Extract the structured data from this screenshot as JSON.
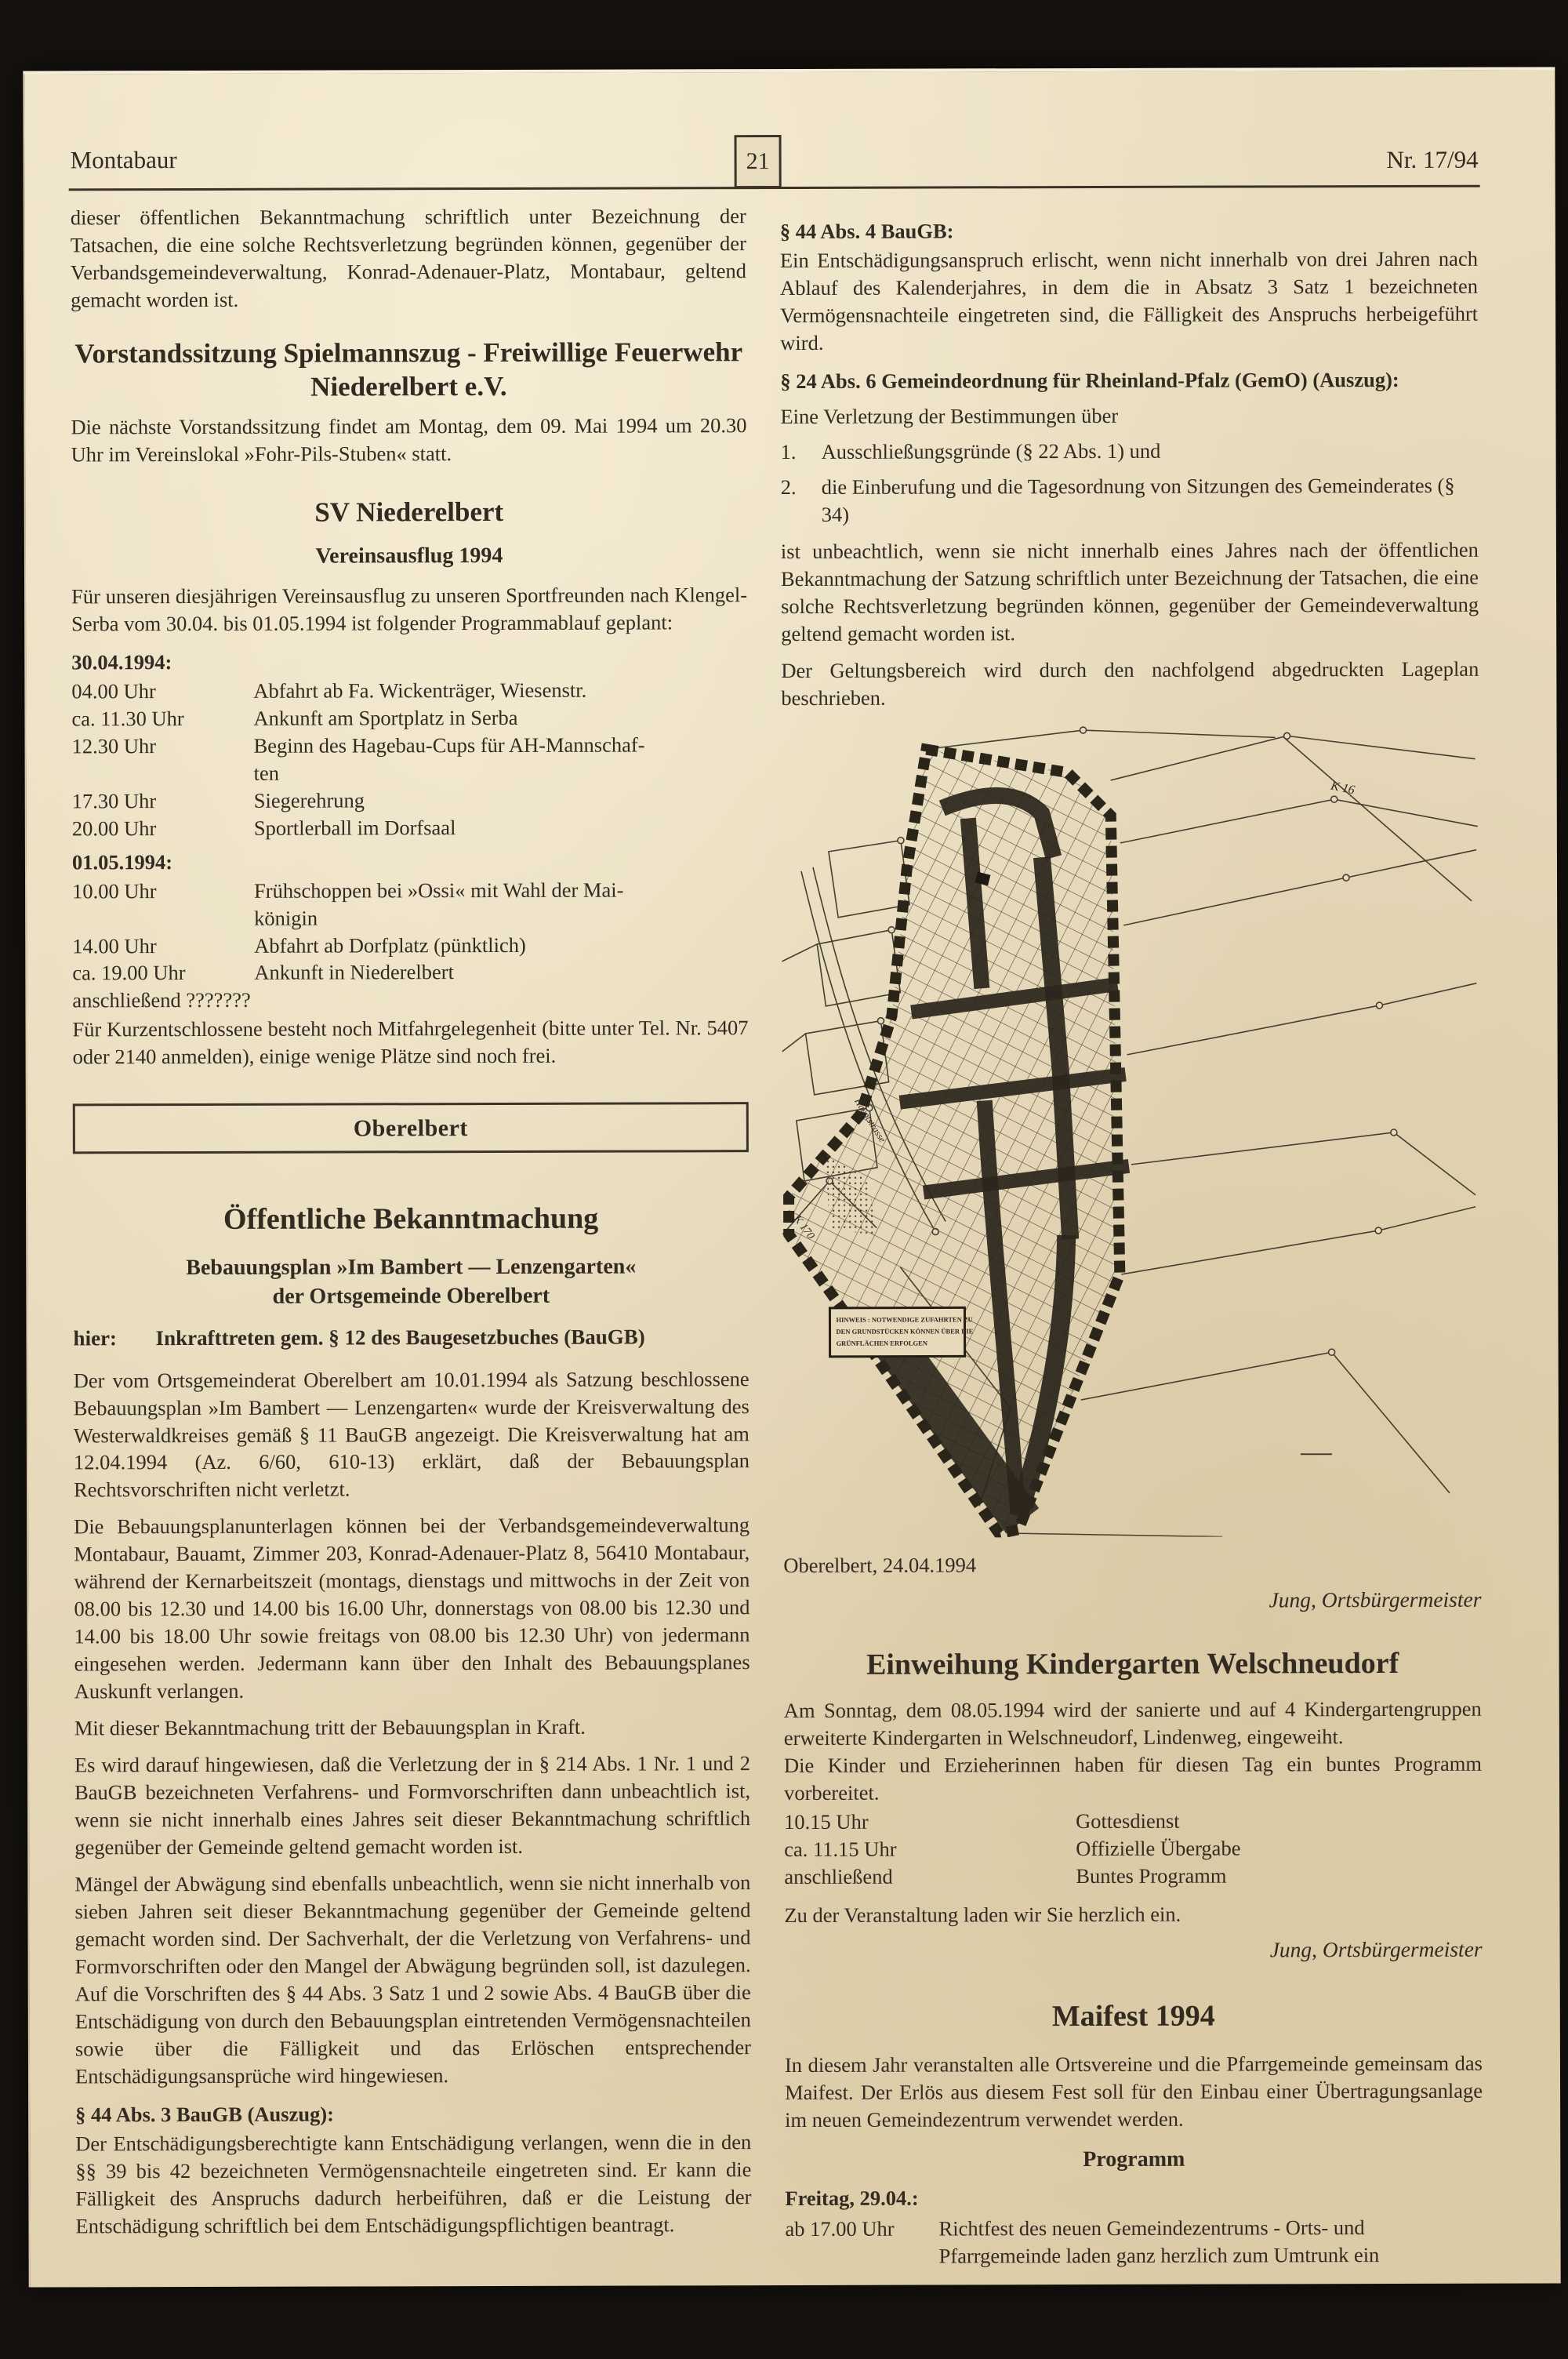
{
  "header": {
    "publication": "Montabaur",
    "page_number": "21",
    "issue": "Nr. 17/94"
  },
  "left_column": {
    "intro": "dieser öffentlichen Bekanntmachung schriftlich unter Bezeichnung der Tatsachen, die eine solche Rechtsverletzung begründen können, gegenüber der Verbandsgemeindeverwaltung, Konrad-Adenauer-Platz, Montabaur, geltend gemacht worden ist.",
    "vorstand": {
      "title": "Vorstandssitzung Spielmannszug - Freiwillige Feuerwehr Niederelbert e.V.",
      "body": "Die nächste Vorstandssitzung findet am Montag, dem 09. Mai 1994 um 20.30 Uhr im Vereinslokal »Fohr-Pils-Stuben« statt."
    },
    "sv": {
      "title": "SV Niederelbert",
      "subtitle": "Vereinsausflug 1994",
      "intro": "Für unseren diesjährigen Vereinsausflug zu unseren Sportfreunden nach Klengel-Serba vom 30.04. bis 01.05.1994 ist folgender Programmablauf geplant:",
      "day1_label": "30.04.1994:",
      "day1": [
        {
          "time": "04.00 Uhr",
          "desc": "Abfahrt ab Fa. Wickenträger, Wiesenstr."
        },
        {
          "time": "ca. 11.30 Uhr",
          "desc": "Ankunft am Sportplatz in Serba"
        },
        {
          "time": "12.30 Uhr",
          "desc": "Beginn des Hagebau-Cups für AH-Mannschaf-\nten"
        },
        {
          "time": "17.30 Uhr",
          "desc": "Siegerehrung"
        },
        {
          "time": "20.00 Uhr",
          "desc": "Sportlerball im Dorfsaal"
        }
      ],
      "day2_label": "01.05.1994:",
      "day2": [
        {
          "time": "10.00 Uhr",
          "desc": "Frühschoppen bei »Ossi« mit Wahl der Mai-\nkönigin"
        },
        {
          "time": "14.00 Uhr",
          "desc": "Abfahrt ab Dorfplatz (pünktlich)"
        },
        {
          "time": "ca. 19.00 Uhr",
          "desc": "Ankunft in Niederelbert"
        }
      ],
      "anschliessend_line": "anschließend ???????",
      "outro": "Für Kurzentschlossene besteht noch Mitfahrgelegenheit (bitte unter Tel. Nr. 5407 oder 2140 anmelden), einige wenige Plätze sind noch frei."
    },
    "oberelbert_box": "Oberelbert",
    "bekanntmachung": {
      "title": "Öffentliche Bekanntmachung",
      "subtitle1": "Bebauungsplan »Im Bambert — Lenzengarten«",
      "subtitle2": "der Ortsgemeinde Oberelbert",
      "hier_label": "hier:",
      "hier_text": "Inkrafttreten gem. § 12 des Baugesetzbuches (BauGB)",
      "p1": "Der vom Ortsgemeinderat Oberelbert am 10.01.1994 als Satzung beschlossene Bebauungsplan »Im Bambert — Lenzengarten« wurde der Kreisverwaltung des Westerwaldkreises gemäß § 11 BauGB angezeigt. Die Kreisverwaltung hat am 12.04.1994 (Az. 6/60, 610-13) erklärt, daß der Bebauungsplan Rechtsvorschriften nicht verletzt.",
      "p2": "Die Bebauungsplanunterlagen können bei der Verbandsgemeindeverwaltung Montabaur, Bauamt, Zimmer 203, Konrad-Adenauer-Platz 8, 56410 Montabaur, während der Kernarbeitszeit (montags, dienstags und mittwochs in der Zeit von 08.00 bis 12.30 und 14.00 bis 16.00 Uhr, donnerstags von 08.00 bis 12.30 und 14.00 bis 18.00 Uhr sowie freitags von 08.00 bis 12.30 Uhr) von jedermann eingesehen werden. Jedermann kann über den Inhalt des Bebauungsplanes Auskunft verlangen.",
      "p3": "Mit dieser Bekanntmachung tritt der Bebauungsplan in Kraft.",
      "p4": "Es wird darauf hingewiesen, daß die Verletzung der in § 214 Abs. 1 Nr. 1 und 2 BauGB bezeichneten Verfahrens- und Formvorschriften dann unbeachtlich ist, wenn sie nicht innerhalb eines Jahres seit dieser Bekanntmachung schriftlich gegenüber der Gemeinde geltend gemacht worden ist.",
      "p5": "Mängel der Abwägung sind ebenfalls unbeachtlich, wenn sie nicht innerhalb von sieben Jahren seit dieser Bekanntmachung gegenüber der Gemeinde geltend gemacht worden sind. Der Sachverhalt, der die Verletzung von Verfahrens- und Formvorschriften oder den Mangel der Abwägung begründen soll, ist dazulegen. Auf die Vorschriften des § 44 Abs. 3 Satz 1 und 2 sowie Abs. 4 BauGB über die Entschädigung von durch den Bebauungsplan eintretenden Vermögensnachteilen sowie über die Fälligkeit und das Erlöschen entsprechender Entschädigungsansprüche wird hingewiesen.",
      "s44_3_label": "§ 44 Abs. 3 BauGB (Auszug):",
      "s44_3_text": "Der Entschädigungsberechtigte kann Entschädigung verlangen, wenn die in den §§ 39 bis 42 bezeichneten Vermögensnachteile eingetreten sind. Er kann die Fälligkeit des Anspruchs dadurch herbeiführen, daß er die Leistung der Entschädigung schriftlich bei dem Entschädigungspflichtigen beantragt."
    }
  },
  "right_column": {
    "s44_4_label": "§ 44 Abs. 4 BauGB:",
    "s44_4_text": "Ein Entschädigungsanspruch erlischt, wenn nicht innerhalb von drei Jahren nach Ablauf des Kalenderjahres, in dem die in Absatz 3 Satz 1 bezeichneten Vermögensnachteile eingetreten sind, die Fälligkeit des Anspruchs herbeigeführt wird.",
    "gemo_label": "§ 24 Abs. 6 Gemeindeordnung für Rheinland-Pfalz (GemO) (Auszug):",
    "gemo_intro": "Eine Verletzung der Bestimmungen über",
    "gemo_items": [
      {
        "num": "1.",
        "text": "Ausschließungsgründe (§ 22 Abs. 1) und"
      },
      {
        "num": "2.",
        "text": "die Einberufung und die Tagesordnung von Sitzungen des Gemeinderates (§ 34)"
      }
    ],
    "gemo_outro": "ist unbeachtlich, wenn sie nicht innerhalb eines Jahres nach der öffentlichen Bekanntmachung der Satzung schriftlich unter Bezeichnung der Tatsachen, die eine solche Rechtsverletzung begründen können, gegenüber der Gemeindeverwaltung geltend gemacht worden ist.",
    "geltungsbereich": "Der Geltungsbereich wird durch den nachfolgend abgedruckten Lageplan beschrieben.",
    "map": {
      "label_k16": "K 16",
      "label_k170": "K 170",
      "label_street": "Hauptstrasse",
      "legend_line1": "HINWEIS : NOTWENDIGE ZUFAHRTEN ZU",
      "legend_line2": "DEN GRUNDSTÜCKEN KÖNNEN ÜBER DIE",
      "legend_line3": "GRÜNFLÄCHEN ERFOLGEN"
    },
    "date_line": "Oberelbert, 24.04.1994",
    "signature1": "Jung, Ortsbürgermeister",
    "kindergarten": {
      "title": "Einweihung Kindergarten Welschneudorf",
      "p1": "Am Sonntag, dem 08.05.1994 wird der sanierte und auf 4 Kindergartengruppen erweiterte Kindergarten in Welschneudorf, Lindenweg, eingeweiht.",
      "p2": "Die Kinder und Erzieherinnen haben für diesen Tag ein buntes Programm vorbereitet.",
      "schedule": [
        {
          "time": "10.15 Uhr",
          "desc": "Gottesdienst"
        },
        {
          "time": "ca. 11.15 Uhr",
          "desc": "Offizielle Übergabe"
        },
        {
          "time": "anschließend",
          "desc": "Buntes Programm"
        }
      ],
      "outro": "Zu der Veranstaltung laden wir Sie herzlich ein.",
      "signature": "Jung, Ortsbürgermeister"
    },
    "maifest": {
      "title": "Maifest 1994",
      "p1": "In diesem Jahr veranstalten alle Ortsvereine und die Pfarrgemeinde gemeinsam das Maifest. Der Erlös aus diesem Fest soll für den Einbau einer Übertragungsanlage im neuen Gemeindezentrum verwendet werden.",
      "program_label": "Programm",
      "day_label": "Freitag, 29.04.:",
      "row_time": "ab 17.00 Uhr",
      "row_desc": "Richtfest des neuen Gemeindezentrums\n- Orts- und Pfarrgemeinde laden ganz herzlich\nzum Umtrunk ein"
    }
  }
}
